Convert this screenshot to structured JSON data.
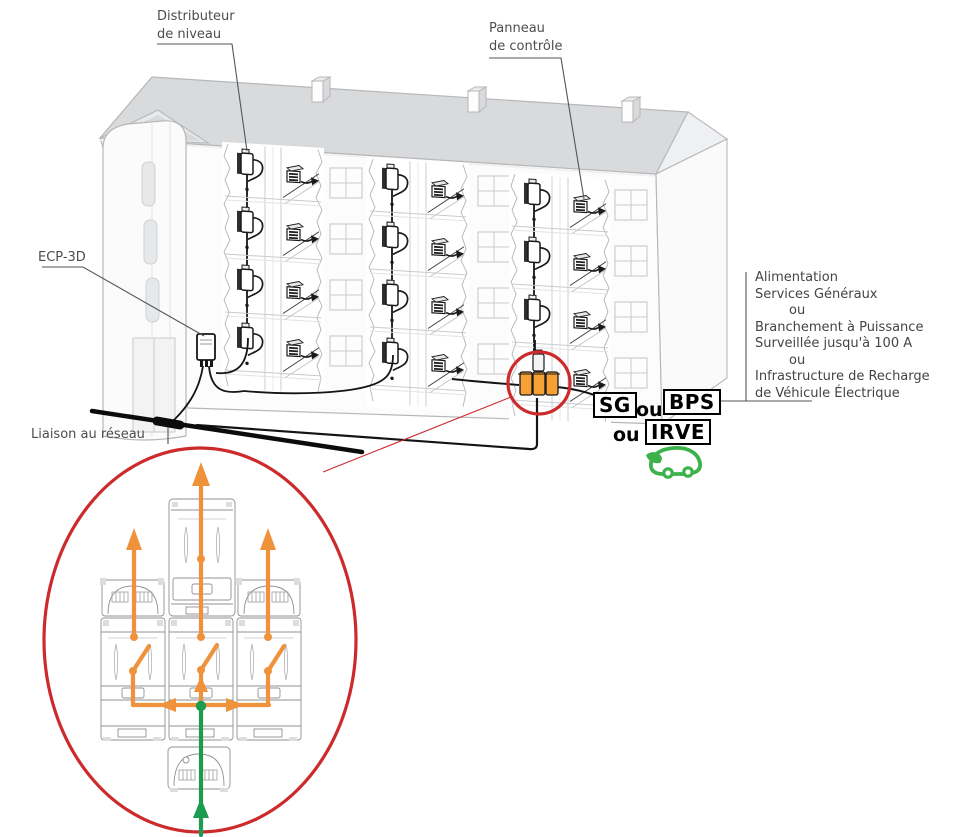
{
  "diagram": {
    "labels": {
      "level_distributor": {
        "line1": "Distributeur",
        "line2": "de niveau"
      },
      "control_panel": {
        "line1": "Panneau",
        "line2": "de contrôle"
      },
      "ecp3d": "ECP-3D",
      "network_link": "Liaison au réseau"
    },
    "supply_options": {
      "lines": [
        "Alimentation",
        "Services Généraux",
        "ou",
        "Branchement à Puissance",
        "Surveillée jusqu'à 100 A",
        "ou",
        "Infrastructure de Recharge",
        "de Véhicule Électrique"
      ]
    },
    "connection_badges": {
      "sg": "SG",
      "or1": "ou",
      "bps": "BPS",
      "or2": "ou",
      "irve": "IRVE"
    },
    "icons": [
      "ev-car-icon",
      "distribution-box-icon",
      "control-panel-icon"
    ],
    "colors": {
      "highlight_red": "#cd2a2c",
      "flow_orange": "#f0923c",
      "flow_green": "#1d9b4e",
      "ev_green": "#3cb24b",
      "module_orange": "#f7a033",
      "roof_gray": "#d9dadb",
      "line_gray": "#b6b7b9",
      "cable_black": "#141416"
    }
  }
}
